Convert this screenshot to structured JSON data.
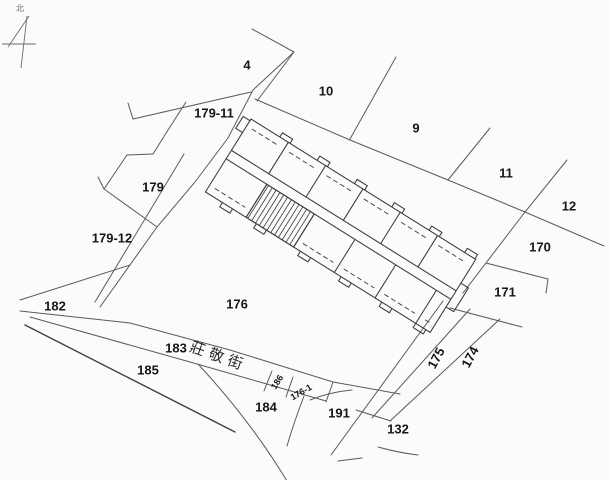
{
  "map": {
    "type": "cadastral-parcel-map",
    "north_label": "北",
    "street": {
      "name": "莊敬街",
      "x": 217,
      "y": 361,
      "rotation": 20
    },
    "parcels": [
      {
        "id": "4",
        "x": 247,
        "y": 65
      },
      {
        "id": "10",
        "x": 326,
        "y": 91
      },
      {
        "id": "179-11",
        "x": 214,
        "y": 113
      },
      {
        "id": "9",
        "x": 416,
        "y": 128
      },
      {
        "id": "179",
        "x": 153,
        "y": 187
      },
      {
        "id": "11",
        "x": 506,
        "y": 173
      },
      {
        "id": "12",
        "x": 569,
        "y": 206
      },
      {
        "id": "179-12",
        "x": 112,
        "y": 238
      },
      {
        "id": "170",
        "x": 540,
        "y": 247
      },
      {
        "id": "171",
        "x": 505,
        "y": 292
      },
      {
        "id": "176",
        "x": 237,
        "y": 304
      },
      {
        "id": "182",
        "x": 55,
        "y": 306
      },
      {
        "id": "183",
        "x": 176,
        "y": 348
      },
      {
        "id": "185",
        "x": 148,
        "y": 370
      },
      {
        "id": "184",
        "x": 266,
        "y": 407
      },
      {
        "id": "191",
        "x": 339,
        "y": 413
      },
      {
        "id": "132",
        "x": 398,
        "y": 429
      },
      {
        "id": "175",
        "x": 436,
        "y": 358,
        "rot": -62
      },
      {
        "id": "174",
        "x": 470,
        "y": 357,
        "rot": -62
      },
      {
        "id": "186",
        "x": 277,
        "y": 382,
        "rot": -58,
        "size": 9
      },
      {
        "id": "176-1",
        "x": 301,
        "y": 392,
        "rot": -30,
        "size": 9
      }
    ],
    "building": {
      "hatched_unit": true
    }
  },
  "theme": {
    "bg": "#fbfbfa",
    "line": "#5a5a5a",
    "building-line": "#3a3a3a",
    "dark-line": "#3f3f3f",
    "label": "#161616",
    "street-label": "#2a2a2a",
    "north": "#6a6a6a"
  }
}
